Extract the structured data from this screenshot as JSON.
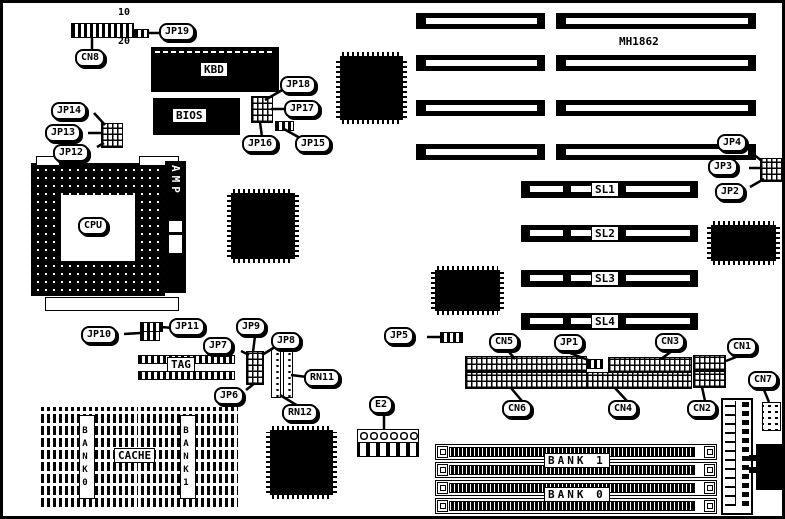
{
  "board": {
    "model": "MH1862"
  },
  "cn8_pins": {
    "top": "10",
    "bottom": "20"
  },
  "labels": {
    "cn8": "CN8",
    "jp19": "JP19",
    "kbd": "KBD",
    "bios": "BIOS",
    "jp18": "JP18",
    "jp17": "JP17",
    "jp16": "JP16",
    "jp15": "JP15",
    "jp14": "JP14",
    "jp13": "JP13",
    "jp12": "JP12",
    "cpu": "CPU",
    "amp": "AMP",
    "jp4": "JP4",
    "jp3": "JP3",
    "jp2": "JP2",
    "sl1": "SL1",
    "sl2": "SL2",
    "sl3": "SL3",
    "sl4": "SL4",
    "jp10": "JP10",
    "jp11": "JP11",
    "tag": "TAG",
    "jp7": "JP7",
    "jp9": "JP9",
    "jp8": "JP8",
    "jp6": "JP6",
    "rn11": "RN11",
    "rn12": "RN12",
    "jp5": "JP5",
    "jp1": "JP1",
    "cn5": "CN5",
    "cn3": "CN3",
    "cn1": "CN1",
    "cn6": "CN6",
    "cn4": "CN4",
    "cn2": "CN2",
    "cn7": "CN7",
    "e2": "E2",
    "cache": "CACHE",
    "bank0_chips": "BANK0",
    "bank1_chips": "BANK1",
    "bank1_simm": "BANK 1",
    "bank0_simm": "BANK 0"
  },
  "colors": {
    "line": "#000000",
    "background": "#ffffff"
  }
}
